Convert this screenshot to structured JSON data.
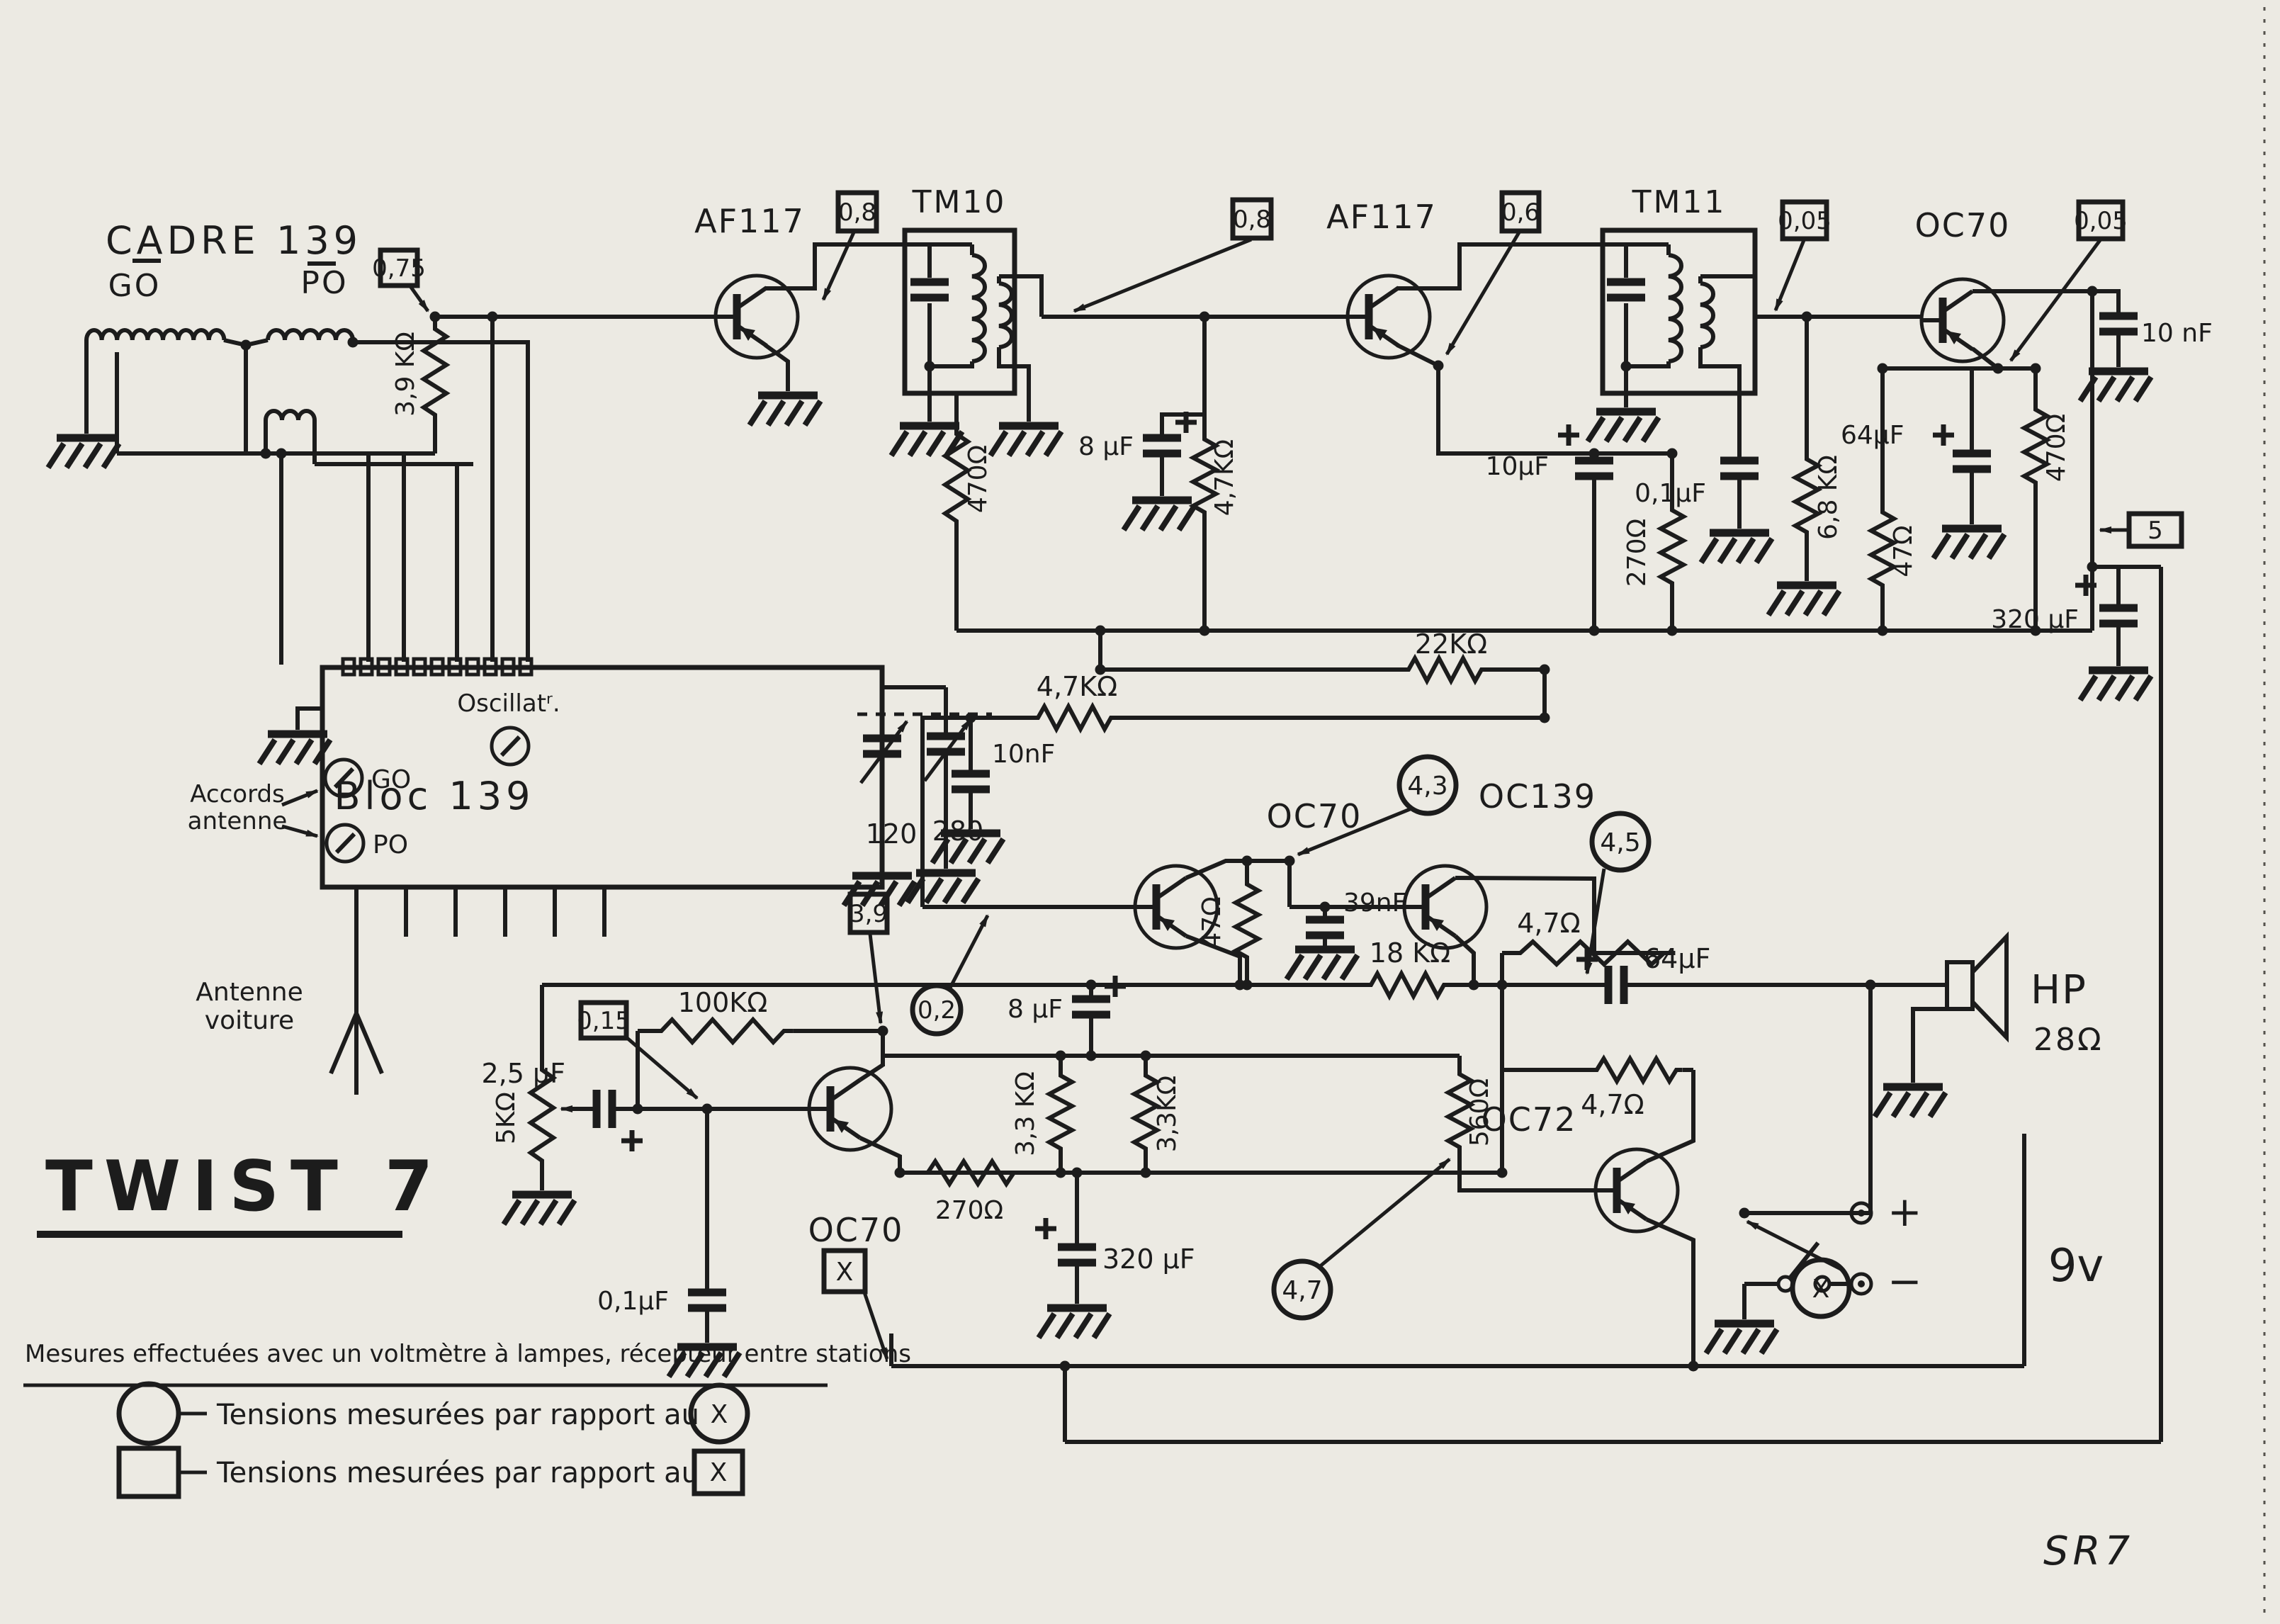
{
  "title": "TWIST 7",
  "sheet_code": "SR7",
  "cadre": {
    "title": "CADRE 139",
    "go": "GO",
    "po": "PO"
  },
  "tuner_block": {
    "name": "Bloc 139",
    "oscillator": "Oscillatʳ.",
    "go": "GO",
    "po": "PO",
    "cap_go": "120",
    "cap_po": "280",
    "accords_line1": "Accords",
    "accords_line2": "antenne",
    "antenna_line1": "Antenne",
    "antenna_line2": "voiture"
  },
  "transistors": {
    "q1": "AF117",
    "q2": "AF117",
    "q3": "OC70",
    "q4": "OC70",
    "q5": "OC139",
    "q6": "OC72",
    "q7": "OC70"
  },
  "transformers": {
    "tm10": "TM10",
    "tm11": "TM11"
  },
  "voltages_boxed": {
    "v075": "0,75",
    "v08a": "0,8",
    "v08b": "0,8",
    "v06": "0,6",
    "v005a": "0,05",
    "v005b": "0,05",
    "v5": "5",
    "v39": "3,9",
    "v015": "0,15",
    "x": "X"
  },
  "voltages_circled": {
    "v43": "4,3",
    "v45": "4,5",
    "v02": "0,2",
    "v47": "4,7",
    "x": "X"
  },
  "components": {
    "r_3k9": "3,9 KΩ",
    "r_470_if1": "470Ω",
    "c_8uf_if": "8 μF",
    "r_4k7_if": "4,7KΩ",
    "c_10uf": "10μF",
    "r_270_if": "270Ω",
    "c_01uf_if": "0,1μF",
    "r_6k8": "6,8 KΩ",
    "r_47_if": "47Ω",
    "c_64uf_if": "64μF",
    "r_470_det": "470Ω",
    "c_10nf_det": "10 nF",
    "c_320uf_psu": "320 μF",
    "r_22k": "22KΩ",
    "r_4k7_agc": "4,7KΩ",
    "c_10nf_agc": "10nF",
    "r_47_af": "47Ω",
    "c_39nf": "39nF",
    "r_4k7_drv": "4,7Ω",
    "r_18k": "18 KΩ",
    "c_64uf_out": "64μF",
    "r_4k7_out": "4,7Ω",
    "r_560": "560Ω",
    "r_100k": "100KΩ",
    "c_8uf_af": "8 μF",
    "c_2u5": "2,5 μF",
    "r_5k": "5KΩ",
    "c_01uf_af": "0,1μF",
    "r_270_af": "270Ω",
    "r_3k3_a": "3,3 KΩ",
    "r_3k3_b": "3,3KΩ",
    "c_320uf_af": "320 μF"
  },
  "speaker": {
    "label": "HP",
    "impedance": "28Ω"
  },
  "battery": {
    "voltage": "9v",
    "plus": "+",
    "minus": "−"
  },
  "legend": {
    "note": "Mesures effectuées avec un voltmètre à lampes, récepteur entre stations",
    "circle_text": "Tensions mesurées par rapport au",
    "box_text": "Tensions mesurées par rapport au",
    "x_circle": "X",
    "x_box": "X"
  }
}
